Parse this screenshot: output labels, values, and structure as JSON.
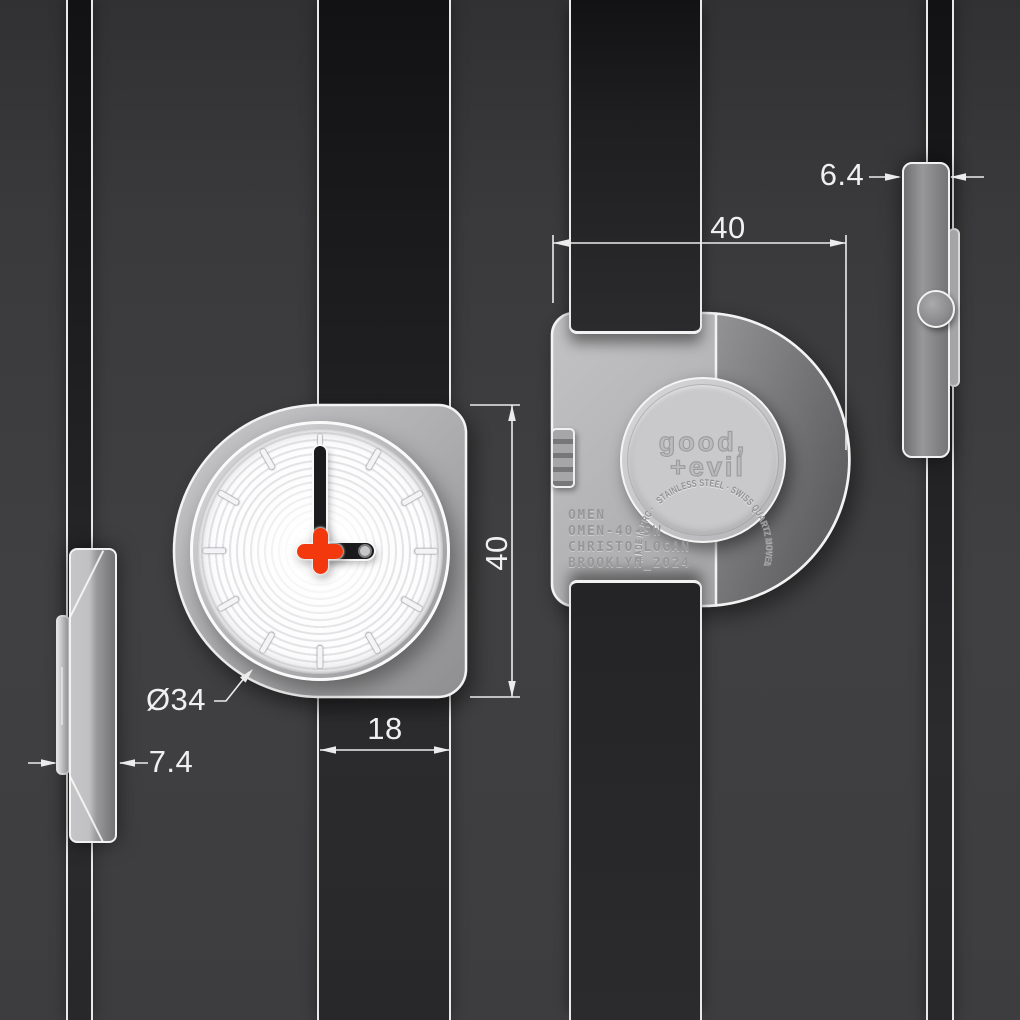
{
  "dims": {
    "back_case_width": "40",
    "front_case_height": "40",
    "strap_width": "18",
    "dial_diameter": "Ø34",
    "left_profile_thickness": "7.4",
    "right_profile_thickness": "6.4"
  },
  "caseback": {
    "ring_text": "STAINLESS STEEL · SWISS QUARTZ MOVEMENT · SAPPHIRE CRYSTAL · 5 ATM WATER · MADE IN PRC · ",
    "logo_line1": "good,",
    "logo_line2": "+evil",
    "engraving_lines": [
      "OMEN",
      "OMEN-40-SW",
      "CHRISTO_LOGAN",
      "BROOKLYN_2024"
    ]
  },
  "front": {
    "time_shown": "3:00"
  },
  "colors": {
    "background": "#3d3d3f",
    "strap": "#1e1e20",
    "outline": "#f3f3f3",
    "accent_red": "#f2380c",
    "dimension_text": "#f0f0f0"
  }
}
